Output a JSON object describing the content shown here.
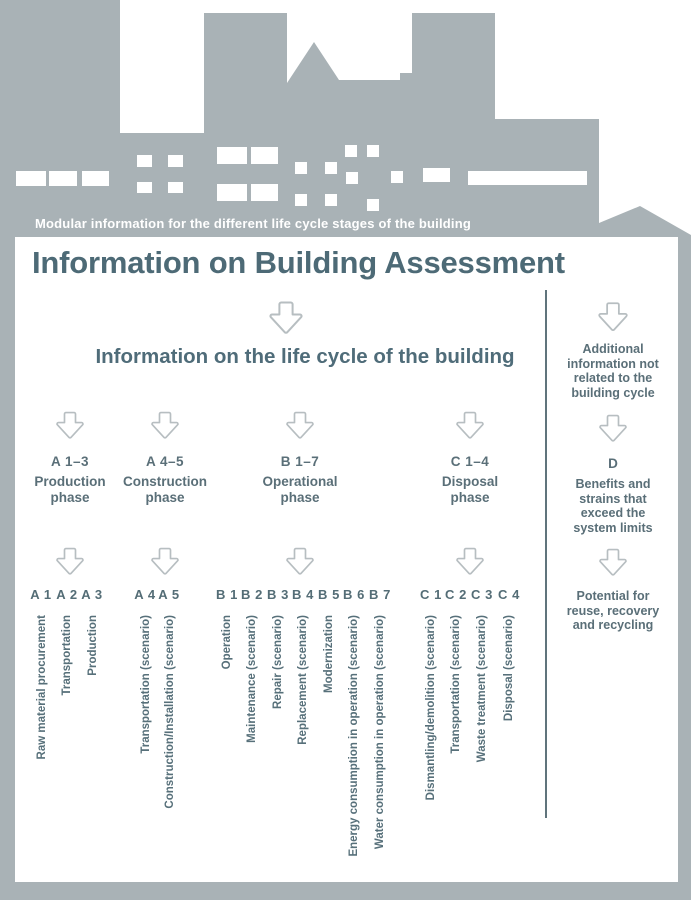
{
  "colors": {
    "building_gray": "#a9b2b6",
    "title_teal": "#4d6a76",
    "text_slate": "#5a6f78",
    "arrow_outline": "#b7bec1",
    "divider": "#60747c"
  },
  "banner": {
    "caption": "Modular information for the different life cycle stages of the building"
  },
  "header": {
    "title": "Information on Building Assessment"
  },
  "main": {
    "heading": "Information on the life cycle of the building",
    "phases": [
      {
        "code": "A 1–3",
        "name_line1": "Production",
        "name_line2": "phase",
        "modules": [
          {
            "code": "A 1",
            "label": "Raw material procurement"
          },
          {
            "code": "A 2",
            "label": "Transportation"
          },
          {
            "code": "A 3",
            "label": "Production"
          }
        ]
      },
      {
        "code": "A 4–5",
        "name_line1": "Construction",
        "name_line2": "phase",
        "modules": [
          {
            "code": "A 4",
            "label": "Transportation (scenario)"
          },
          {
            "code": "A 5",
            "label": "Construction/Installation (scenario)"
          }
        ]
      },
      {
        "code": "B 1–7",
        "name_line1": "Operational",
        "name_line2": "phase",
        "modules": [
          {
            "code": "B 1",
            "label": "Operation"
          },
          {
            "code": "B 2",
            "label": "Maintenance (scenario)"
          },
          {
            "code": "B 3",
            "label": "Repair (scenario)"
          },
          {
            "code": "B 4",
            "label": "Replacement (scenario)"
          },
          {
            "code": "B 5",
            "label": "Modernization"
          },
          {
            "code": "B 6",
            "label": "Energy consumption in operation (scenario)"
          },
          {
            "code": "B 7",
            "label": "Water consumption in operation (scenario)"
          }
        ]
      },
      {
        "code": "C 1–4",
        "name_line1": "Disposal",
        "name_line2": "phase",
        "modules": [
          {
            "code": "C 1",
            "label": "Dismantling/demolition (scenario)"
          },
          {
            "code": "C 2",
            "label": "Transportation (scenario)"
          },
          {
            "code": "C 3",
            "label": "Waste treatment (scenario)"
          },
          {
            "code": "C 4",
            "label": "Disposal (scenario)"
          }
        ]
      }
    ]
  },
  "sidebar": {
    "note1": [
      "Additional",
      "information not",
      "related to the",
      "building cycle"
    ],
    "d_code": "D",
    "note2": [
      "Benefits and",
      "strains that",
      "exceed the",
      "system limits"
    ],
    "note3": [
      "Potential for",
      "reuse, recovery",
      "and recycling"
    ]
  }
}
